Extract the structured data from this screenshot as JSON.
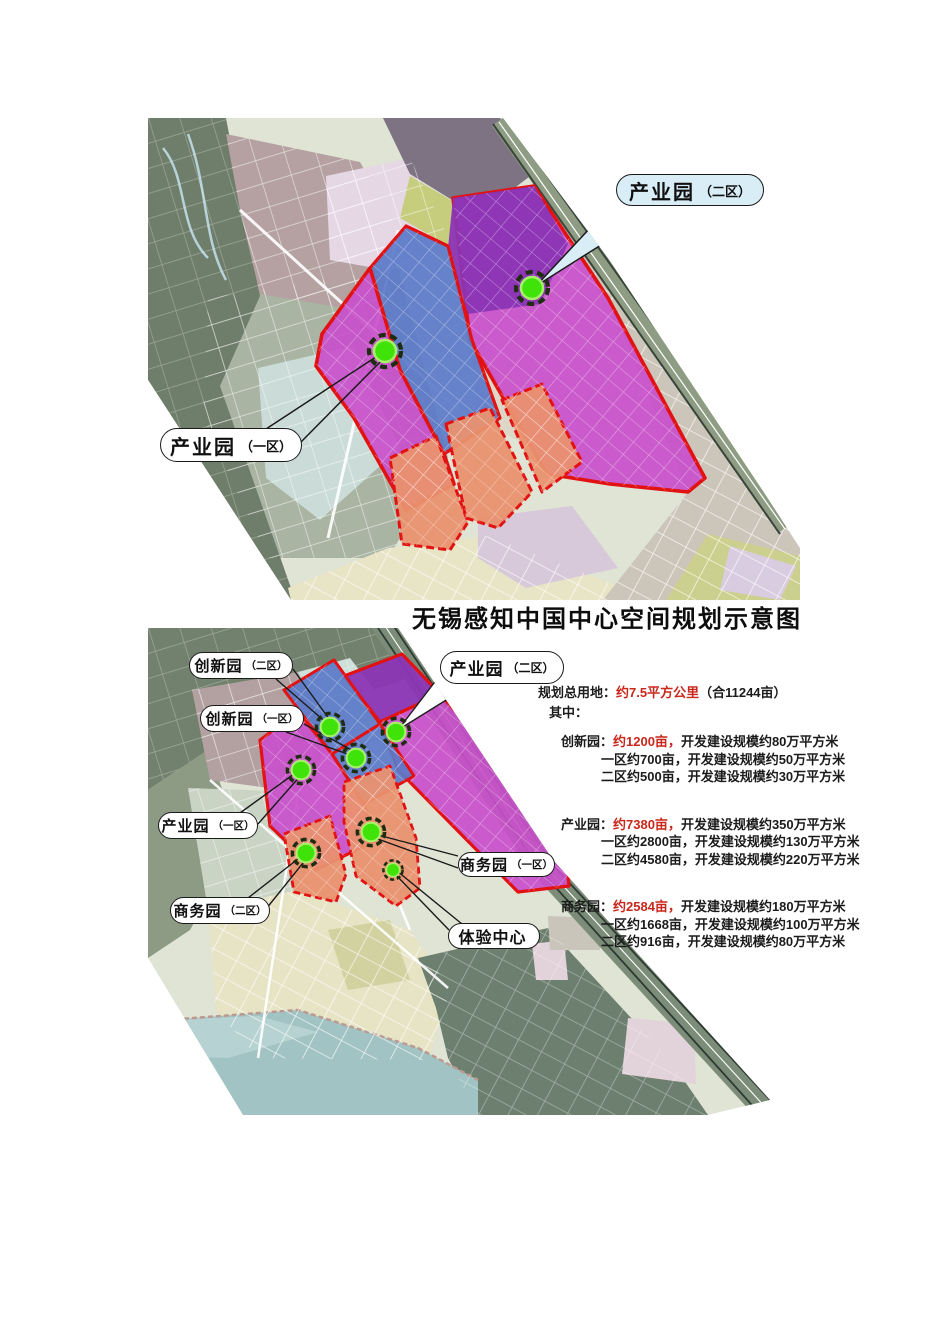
{
  "page": {
    "title": "无锡感知中国中心空间规划示意图"
  },
  "top_map": {
    "labels": [
      {
        "name": "产业园",
        "suffix": "（二区）"
      },
      {
        "name": "产业园",
        "suffix": "（一区）"
      }
    ]
  },
  "bottom_map": {
    "labels": [
      {
        "name": "创新园",
        "suffix": "（二区）"
      },
      {
        "name": "创新园",
        "suffix": "（一区）"
      },
      {
        "name": "产业园",
        "suffix": "（二区）"
      },
      {
        "name": "产业园",
        "suffix": "（一区）"
      },
      {
        "name": "商务园",
        "suffix": "（一区）"
      },
      {
        "name": "商务园",
        "suffix": "（二区）"
      },
      {
        "name": "体验中心",
        "suffix": ""
      }
    ]
  },
  "stats": {
    "total_label": "规划总用地：",
    "total_value": "约7.5平方公里",
    "total_extra": "（合11244亩）",
    "among_label": "其中：",
    "groups": [
      {
        "name": "创新园：",
        "value": "约1200亩，",
        "rest": "开发建设规模约80万平方米",
        "sub": [
          "一区约700亩，开发建设规模约50万平方米",
          "二区约500亩，开发建设规模约30万平方米"
        ]
      },
      {
        "name": "产业园：",
        "value": "约7380亩，",
        "rest": "开发建设规模约350万平方米",
        "sub": [
          "一区约2800亩，开发建设规模约130万平方米",
          "二区约4580亩，开发建设规模约220万平方米"
        ]
      },
      {
        "name": "商务园：",
        "value": "约2584亩，",
        "rest": "开发建设规模约180万平方米",
        "sub": [
          "一区约1668亩，开发建设规模约100万平方米",
          "二区约916亩，开发建设规模约80万平方米"
        ]
      }
    ]
  },
  "colors": {
    "highlight_red": "#e21212",
    "stats_red": "#c9271b",
    "bubble_blue": "#d9edf7",
    "marker_green": "#3fe30a",
    "zone_magenta": "#c94fcb",
    "zone_purple": "#8b35b5",
    "zone_blue": "#5b79c9",
    "zone_orange": "#e9916f"
  }
}
